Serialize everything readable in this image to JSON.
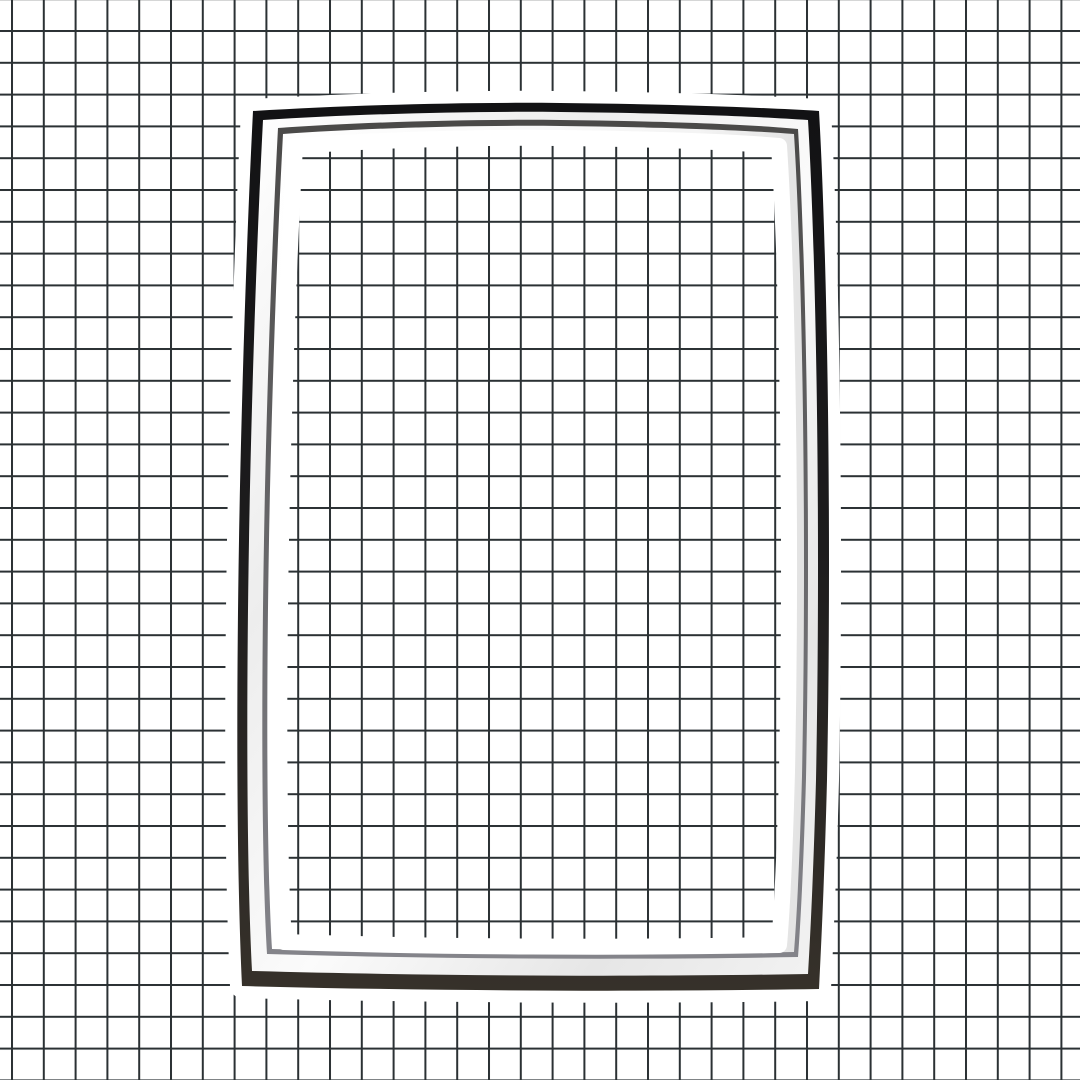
{
  "scene": {
    "canvas": {
      "background": "#ffffff"
    },
    "grid": {
      "spacing": 31.8,
      "line_width": 2,
      "line_color": "#2b3134",
      "offset_x": 11,
      "offset_y": 30
    },
    "gasket": {
      "halo_color": "#ffffff",
      "halo_stroke_width": 24,
      "window_halo_stroke_width": 16,
      "dark_band": {
        "top": "#121214",
        "mid": "#1d1c1d",
        "bottom": "#36312a"
      },
      "chrome_band": {
        "s0": "#ffffff",
        "s1": "#ededed",
        "s2": "#fbfbfb",
        "s3": "#e6e6e6",
        "s4": "#f2f2f2"
      },
      "groove": {
        "top": "#4a4948",
        "bottom": "#84848a"
      },
      "lip": {
        "s0": "#ffffff",
        "s1": "#f4f4f4",
        "s2": "#e2e2e2"
      },
      "paths": {
        "outer": "M 253,111 C 350,105 465,102 560,103 C 660,104 755,107 819,111 C 827,250 832,520 827,780 C 825,860 822,930 819,989 C 640,992 430,991 242,986 C 237,880 236,720 239,540 C 241,420 246,250 253,111 Z",
        "chrome": "M 263,120 C 355,114 470,111 560,112 C 660,113 750,116 808,120 C 816,255 821,520 816,780 C 814,855 811,925 808,974 C 635,977 430,976 252,971 C 247,875 246,715 249,540 C 251,420 256,255 263,120 Z",
        "groove": "M 278,128 C 362,122 472,119 560,120 C 658,121 745,124 798,129 C 806,260 811,520 806,778 C 804,852 801,918 798,957 C 632,960 432,959 267,954 C 262,870 261,712 264,540 C 266,424 271,262 278,128 Z",
        "lip": "M 283,134 C 366,128 473,125 560,126 C 656,127 743,130 794,134 C 802,262 807,520 802,776 C 800,850 797,915 794,952 C 630,955 433,954 272,949 C 267,868 266,710 269,540 C 271,426 276,266 283,134 Z",
        "window": "M 295,146 C 375,140 478,137 560,138 C 652,139 735,142 779,146 C 787,268 792,520 787,772 C 785,845 782,910 779,945 C 625,948 435,947 284,942 C 279,862 278,706 281,540 C 283,430 288,272 295,146 Z"
      }
    }
  }
}
